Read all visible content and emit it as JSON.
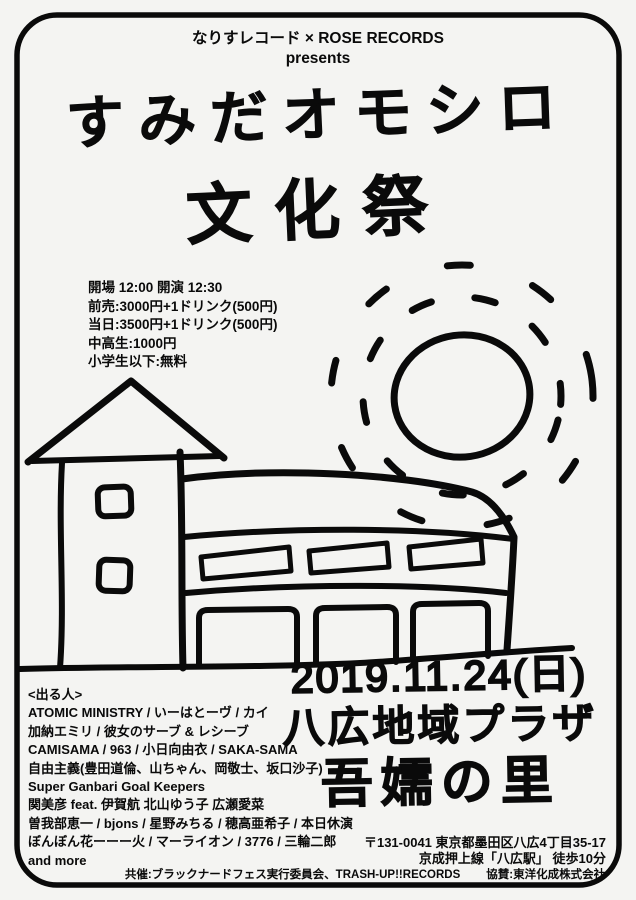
{
  "poster": {
    "header": {
      "line1": "なりすレコード × ROSE RECORDS",
      "line2": "presents"
    },
    "title": {
      "line1": "すみだオモシロ",
      "line2": "文化祭"
    },
    "event_info": {
      "lines": [
        "開場 12:00 開演 12:30",
        "前売:3000円+1ドリンク(500円)",
        "当日:3500円+1ドリンク(500円)",
        "中高生:1000円",
        "小学生以下:無料"
      ]
    },
    "date_venue": {
      "date": "2019.11.24(日)",
      "venue_line1": "八広地域プラザ",
      "venue_line2": "吾嬬の里"
    },
    "lineup": {
      "heading": "<出る人>",
      "lines": [
        "ATOMIC MINISTRY / いーはとーヴ / カイ",
        "加納エミリ / 彼女のサーブ & レシーブ",
        "CAMISAMA / 963 / 小日向由衣 / SAKA-SAMA",
        "自由主義(豊田道倫、山ちゃん、岡敬士、坂口沙子)",
        "Super Ganbari Goal Keepers",
        "関美彦 feat. 伊賀航 北山ゆう子 広瀬愛菜",
        "曽我部恵一 / bjons / 星野みちる / 穂高亜希子 / 本日休演",
        "ぼんぼん花ーーー火 / マーライオン / 3776 / 三輪二郎",
        "and more"
      ]
    },
    "access": {
      "address": "〒131-0041 東京都墨田区八広4丁目35-17",
      "route": "京成押上線「八広駅」 徒歩10分"
    },
    "credits": {
      "co_host": "共催:ブラックナードフェス実行委員会、TRASH-UP!!RECORDS",
      "sponsor": "協賛:東洋化成株式会社"
    },
    "illustration": {
      "elements": [
        "hand-drawn-border",
        "tower-building-doodle",
        "plaza-building-doodle",
        "sun-with-rays-doodle",
        "ground-line-doodle"
      ]
    },
    "colors": {
      "ink": "#0a0a0a",
      "paper": "#f4f4f2"
    }
  }
}
